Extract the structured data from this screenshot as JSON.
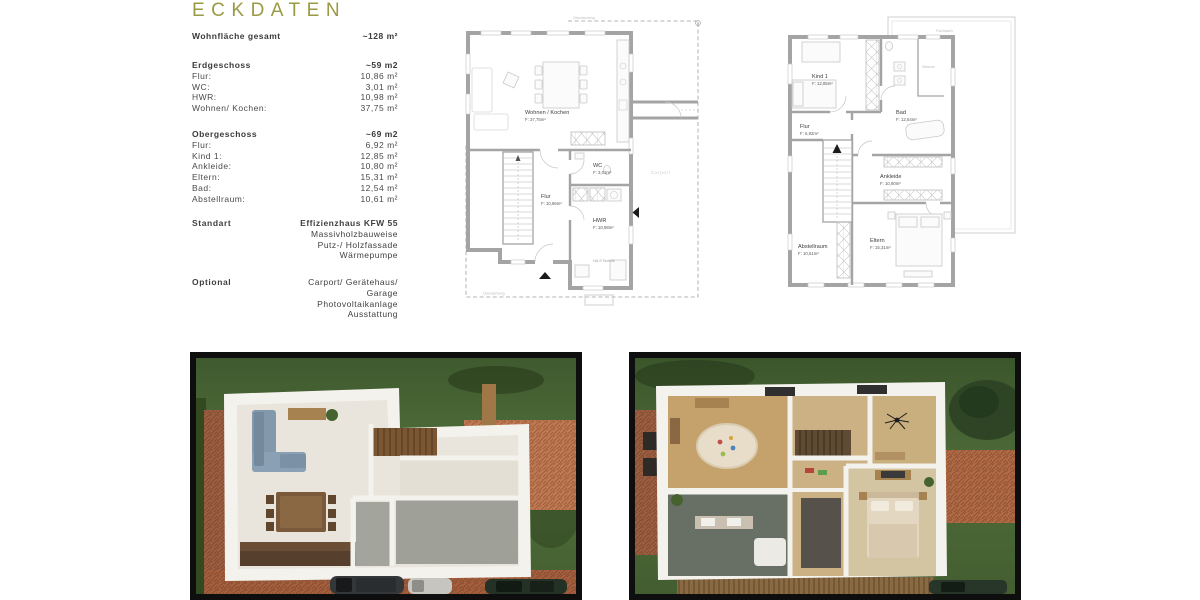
{
  "title": "ECKDATEN",
  "specs": {
    "total_label": "Wohnfläche gesamt",
    "total_value": "~128 m²",
    "eg": {
      "heading": "Erdgeschoss",
      "heading_value": "~59 m2",
      "rows": [
        {
          "label": "Flur:",
          "value": "10,86 m²"
        },
        {
          "label": "WC:",
          "value": "3,01 m²"
        },
        {
          "label": "HWR:",
          "value": "10,98 m²"
        },
        {
          "label": "Wohnen/ Kochen:",
          "value": "37,75 m²"
        }
      ]
    },
    "og": {
      "heading": "Obergeschoss",
      "heading_value": "~69 m2",
      "rows": [
        {
          "label": "Flur:",
          "value": "6,92 m²"
        },
        {
          "label": "Kind 1:",
          "value": "12,85 m²"
        },
        {
          "label": "Ankleide:",
          "value": "10,80 m²"
        },
        {
          "label": "Eltern:",
          "value": "15,31 m²"
        },
        {
          "label": "Bad:",
          "value": "12,54 m²"
        },
        {
          "label": "Abstellraum:",
          "value": "10,61 m²"
        }
      ]
    },
    "standart": {
      "label": "Standart",
      "lines": [
        "Effizienzhaus KFW 55",
        "Massivholzbauweise",
        "Putz-/ Holzfassade",
        "Wärmepumpe"
      ]
    },
    "optional": {
      "label": "Optional",
      "lines": [
        "Carport/ Gerätehaus/",
        "Garage",
        "Photovoltaikanlage",
        "Ausstattung"
      ]
    }
  },
  "plans": {
    "eg": {
      "wohnen_name": "Wohnen / Kochen",
      "wohnen_area": "F: 37,75m²",
      "wc_name": "WC",
      "wc_area": "F: 3,01m²",
      "flur_name": "Flur",
      "flur_area": "F: 10,86m²",
      "hwr_name": "HWR",
      "hwr_area": "F: 10,98m²",
      "ueberdachung": "Überdachung",
      "ueberdachung2": "Überdachung",
      "carport": "Carport",
      "technik": "HA-S Technik"
    },
    "og": {
      "kind_name": "Kind 1",
      "kind_area": "F: 12,85m²",
      "bad_name": "Bad",
      "bad_area": "F: 12,54m²",
      "flur_name": "Flur",
      "flur_area": "F: 6,92m²",
      "ankleide_name": "Ankleide",
      "ankleide_area": "F: 10,80m²",
      "abstell_name": "Abstellraum",
      "abstell_area": "F: 10,61m²",
      "eltern_name": "Eltern",
      "eltern_area": "F: 15,31m²",
      "flachdach": "Flachdach",
      "waesche": "Wäsche"
    }
  },
  "colors": {
    "accent": "#9a9a45",
    "text": "#3f3f3f",
    "plan_wall": "#a4a4a4",
    "grass": "#4c6836",
    "brick": "#a5603f",
    "floor_cream": "#e9e5dc",
    "sofa_blue": "#8298ac",
    "wood": "#a5824f",
    "frame_black": "#0e0e0e"
  }
}
